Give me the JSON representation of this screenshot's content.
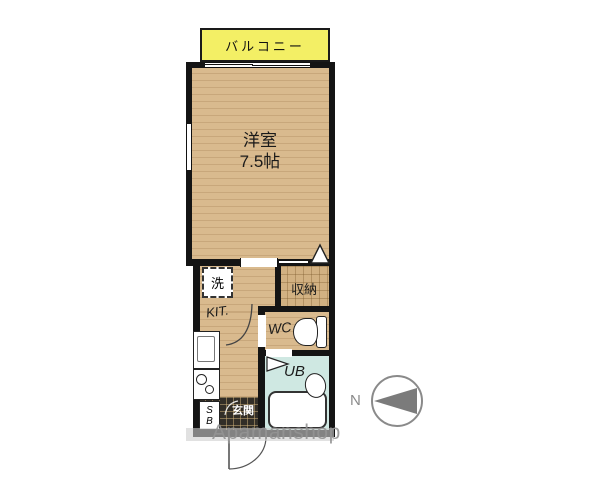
{
  "floorplan": {
    "balcony": {
      "label": "バルコニー"
    },
    "main_room": {
      "name": "洋室",
      "size": "7.5帖"
    },
    "washer": {
      "label": "洗"
    },
    "closet": {
      "label": "収納"
    },
    "kitchen": {
      "label": "KIT."
    },
    "toilet": {
      "label": "WC"
    },
    "bath": {
      "label": "UB"
    },
    "shoebox": {
      "label_top": "S",
      "label_bottom": "B"
    },
    "entrance": {
      "label": "玄関"
    },
    "compass": {
      "label": "N"
    },
    "watermark": "Apamanshop"
  },
  "colors": {
    "balcony_fill": "#f3ef65",
    "wood_floor": "#d9ba8e",
    "closet_floor": "#d2b182",
    "bath_floor": "#cfe8e2",
    "entrance_floor": "#322e27",
    "wall": "#141414",
    "watermark_gray": "#949494",
    "compass_gray": "#8a8a8a"
  }
}
